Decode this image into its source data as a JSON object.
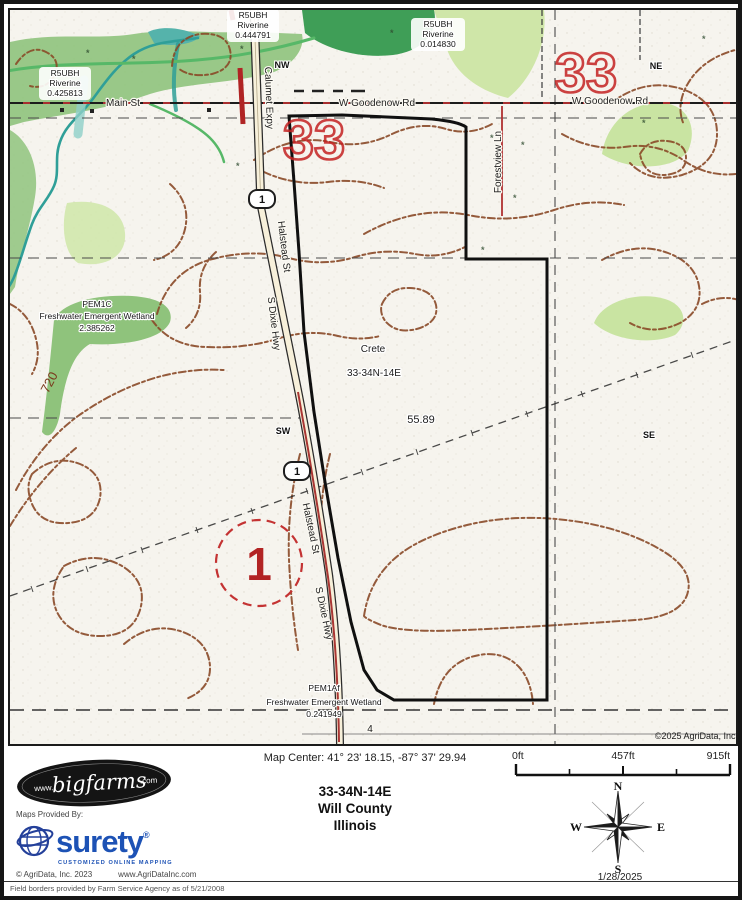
{
  "map": {
    "corners": {
      "nw": "NW",
      "ne": "NE",
      "sw": "SW",
      "se": "SE"
    },
    "section_numbers": {
      "left": "33",
      "right": "33"
    },
    "roads": {
      "main_st": "Main St",
      "w_goodenow": "W Goodenow Rd",
      "calumet_expy": "Calumet Expy",
      "halstead": "Halstead St",
      "s_dixie": "S Dixie Hwy",
      "forestview": "Forestview Ln",
      "route_number": "1",
      "bottom_route": "4"
    },
    "wetlands": {
      "r5ubh_left": {
        "name": "R5UBH",
        "type": "Riverine",
        "value": "0.425813"
      },
      "r5ubh_mid": {
        "name": "R5UBH",
        "type": "Riverine",
        "value": "0.444791"
      },
      "r5ubh_right": {
        "name": "R5UBH",
        "type": "Riverine",
        "value": "0.014830"
      },
      "pem1c": {
        "name": "PEM1C",
        "type": "Freshwater Emergent Wetland",
        "value": "2.385262"
      },
      "pem1af": {
        "name": "PEM1Af",
        "type": "Freshwater Emergent Wetland",
        "value": "0.241949"
      }
    },
    "labels": {
      "place": "Crete",
      "township": "33-34N-14E",
      "acreage": "55.89",
      "contour": "720",
      "field_number": "1",
      "copyright": "©2025 AgriData, Inc."
    }
  },
  "footer": {
    "map_center": "Map Center: 41° 23' 18.15,  -87° 37' 29.94",
    "scale": {
      "t0": "0ft",
      "t1": "457ft",
      "t2": "915ft"
    },
    "logo": {
      "www": "www.",
      "name": "bigfarms",
      "com": ".com"
    },
    "title": {
      "township": "33-34N-14E",
      "county": "Will County",
      "state": "Illinois"
    },
    "provider": {
      "label": "Maps Provided By:",
      "name": "surety",
      "reg": "®",
      "tagline": "CUSTOMIZED ONLINE MAPPING",
      "copyright": "© AgriData, Inc. 2023",
      "site": "www.AgriDataInc.com"
    },
    "compass": {
      "n": "N",
      "s": "S",
      "e": "E",
      "w": "W",
      "date": "1/28/2025"
    },
    "disclaimer": "Field borders provided by Farm Service Agency as of 5/21/2008"
  }
}
